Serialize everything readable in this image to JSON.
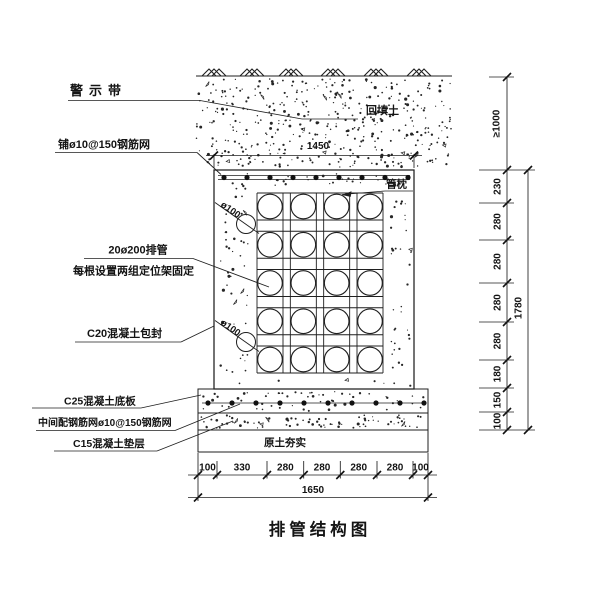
{
  "drawing": {
    "title": "排管结构图",
    "callouts": {
      "warning_tape": "警示带",
      "top_mesh": "铺ø10@150钢筋网",
      "pipes": "20ø200排管",
      "pipes_note": "每根设置两组定位架固定",
      "encasement": "C20混凝土包封",
      "base_slab": "C25混凝土底板",
      "slab_mesh": "中间配钢筋网ø10@150钢筋网",
      "cushion": "C15混凝土垫层",
      "backfill": "回填土",
      "pipe_pillow": "管枕",
      "compacted_soil": "原土夯实",
      "small_pipe_top": "ø100",
      "small_pipe_bottom": "ø100"
    },
    "dimensions": {
      "top_width": "1450",
      "cover_depth": "≥1000",
      "right_chain": [
        "230",
        "280",
        "280",
        "280",
        "280",
        "180",
        "150",
        "100"
      ],
      "right_total": "1780",
      "bottom_chain": [
        "100",
        "330",
        "280",
        "280",
        "280",
        "280",
        "100"
      ],
      "bottom_total": "1650"
    },
    "colors": {
      "ink": "#1f1f1f",
      "paper": "#ffffff"
    }
  }
}
